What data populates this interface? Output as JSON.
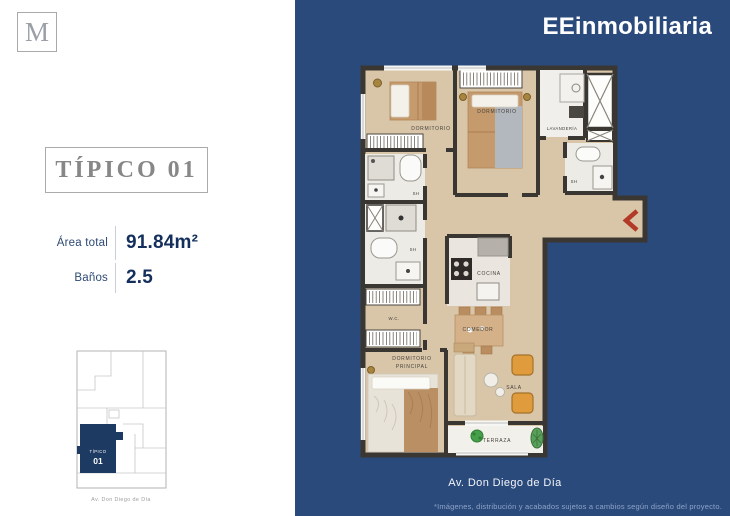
{
  "logo": {
    "letter": "M"
  },
  "header": {
    "brand": "EEinmobiliaria"
  },
  "unit": {
    "title": "TÍPICO 01",
    "specs": [
      {
        "label": "Área total",
        "value": "91.84m²"
      },
      {
        "label": "Baños",
        "value": "2.5"
      }
    ]
  },
  "keyplan": {
    "unit_line1": "TÍPICO",
    "unit_line2": "01",
    "street": "Av. Don Diego de Día"
  },
  "floorplan": {
    "rooms": {
      "dormitorio_1": "DORMITORIO",
      "dormitorio_2": "DORMITORIO",
      "lavanderia": "LAVANDERÍA",
      "sh_top": "SH",
      "sh_mid": "SH",
      "sh_right": "SH",
      "wc": "W.C.",
      "cocina": "COCINA",
      "comedor": "COMEDOR",
      "dormitorio_principal_1": "DORMITORIO",
      "dormitorio_principal_2": "PRINCIPAL",
      "sala": "SALA",
      "terraza": "TERRAZA"
    }
  },
  "footer": {
    "street": "Av. Don Diego de Día",
    "disclaimer": "*Imágenes, distribución y acabados sujetos a cambios según diseño del proyecto."
  },
  "colors": {
    "panel_blue": "#2b4a7c",
    "navy_text": "#142f5c",
    "title_gray": "#878787",
    "wall_dark": "#3a3733",
    "floor_wood": "#d9c6a9",
    "keyplan_highlight": "#1d3a63",
    "entry_arrow_red": "#b23a26",
    "chair_orange": "#e09b3d"
  }
}
